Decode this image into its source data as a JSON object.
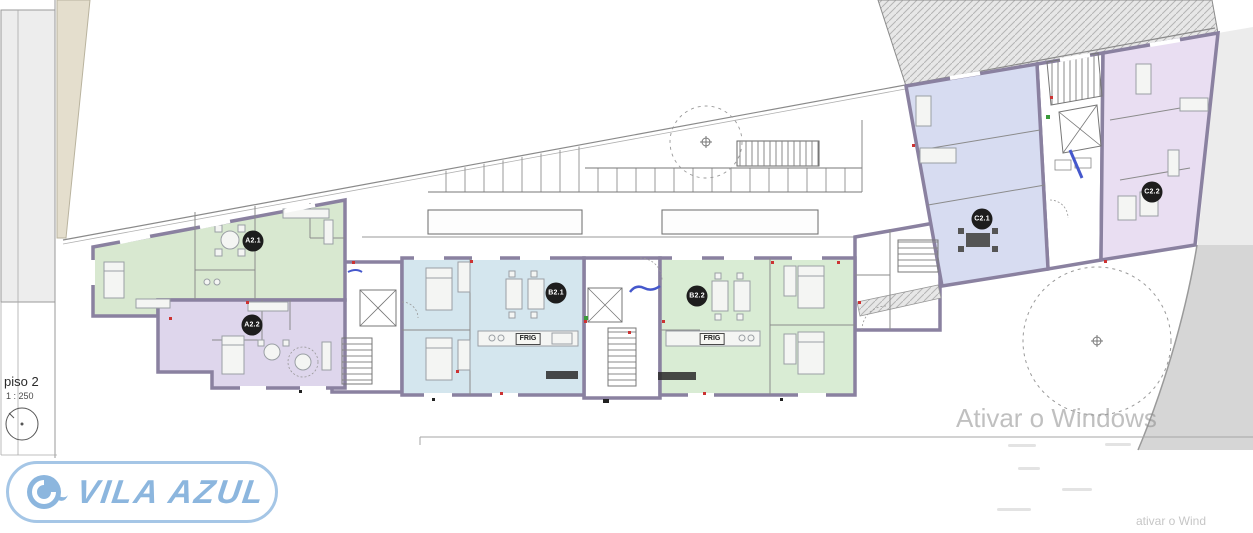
{
  "plan": {
    "floor_label": "piso 2",
    "scale_label": "1 : 250",
    "units": [
      {
        "label": "A2.1",
        "color": "#d8e8d0"
      },
      {
        "label": "A2.2",
        "color": "#ded6ec"
      },
      {
        "label": "B2.1",
        "color": "#d4e6ee"
      },
      {
        "label": "B2.2",
        "color": "#d9ecd4"
      },
      {
        "label": "C2.1",
        "color": "#d7dcf1"
      },
      {
        "label": "C2.2",
        "color": "#e9def2"
      }
    ],
    "appliance_labels": {
      "fridge": "FRIG"
    },
    "wall_color": "#8a81a0",
    "neighbor_hatch_color": "#b5b5b5"
  },
  "branding": {
    "logo_text": "VILA AZUL",
    "logo_color": "#8cb6de"
  },
  "watermark": {
    "activation_text": "Ativar o Windows",
    "corner_text": "ativar o Wind"
  }
}
